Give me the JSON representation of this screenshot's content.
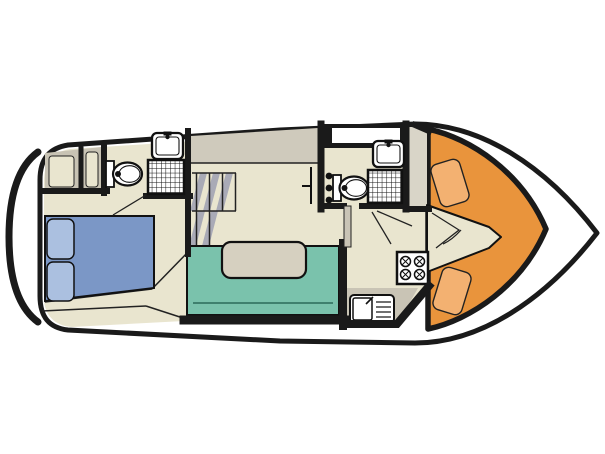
{
  "diagram": {
    "type": "boat-floor-plan",
    "description": "Top-down deck layout of a motor cruiser with bow cabin, two shower rooms, saloon dinette, galley and cockpit seating"
  },
  "colors": {
    "outline": "#1a1a1a",
    "hull_white": "#ffffff",
    "floor": "#e9e5cf",
    "side_band": "#cfcabc",
    "stair_stripe": "#a9aab6",
    "wardrobe_gray": "#c8c3b4",
    "wardrobe_panel": "#e9e5cf",
    "column_gray": "#d9d5c8",
    "counter_gray": "#c9c4b5",
    "door_leaf": "#c9c4b6",
    "bed_blue": "#7b97c6",
    "pillow_blue": "#abc0e0",
    "sofa_teal": "#7ac2ac",
    "table_tan": "#d6d0c0",
    "cockpit_orange": "#e9943c",
    "cushion_orange": "#f3b171",
    "fixture_white": "#ffffff"
  },
  "fixtures": [
    "double-bed",
    "pillows",
    "wardrobe",
    "forward-toilet",
    "forward-shower",
    "forward-washbasin",
    "staircase",
    "u-sofa",
    "dinette-table",
    "aft-toilet",
    "aft-shower",
    "aft-washbasin",
    "roof-window",
    "galley-stove",
    "galley-sink",
    "cockpit-bench",
    "cockpit-cushions",
    "cockpit-walkway"
  ]
}
